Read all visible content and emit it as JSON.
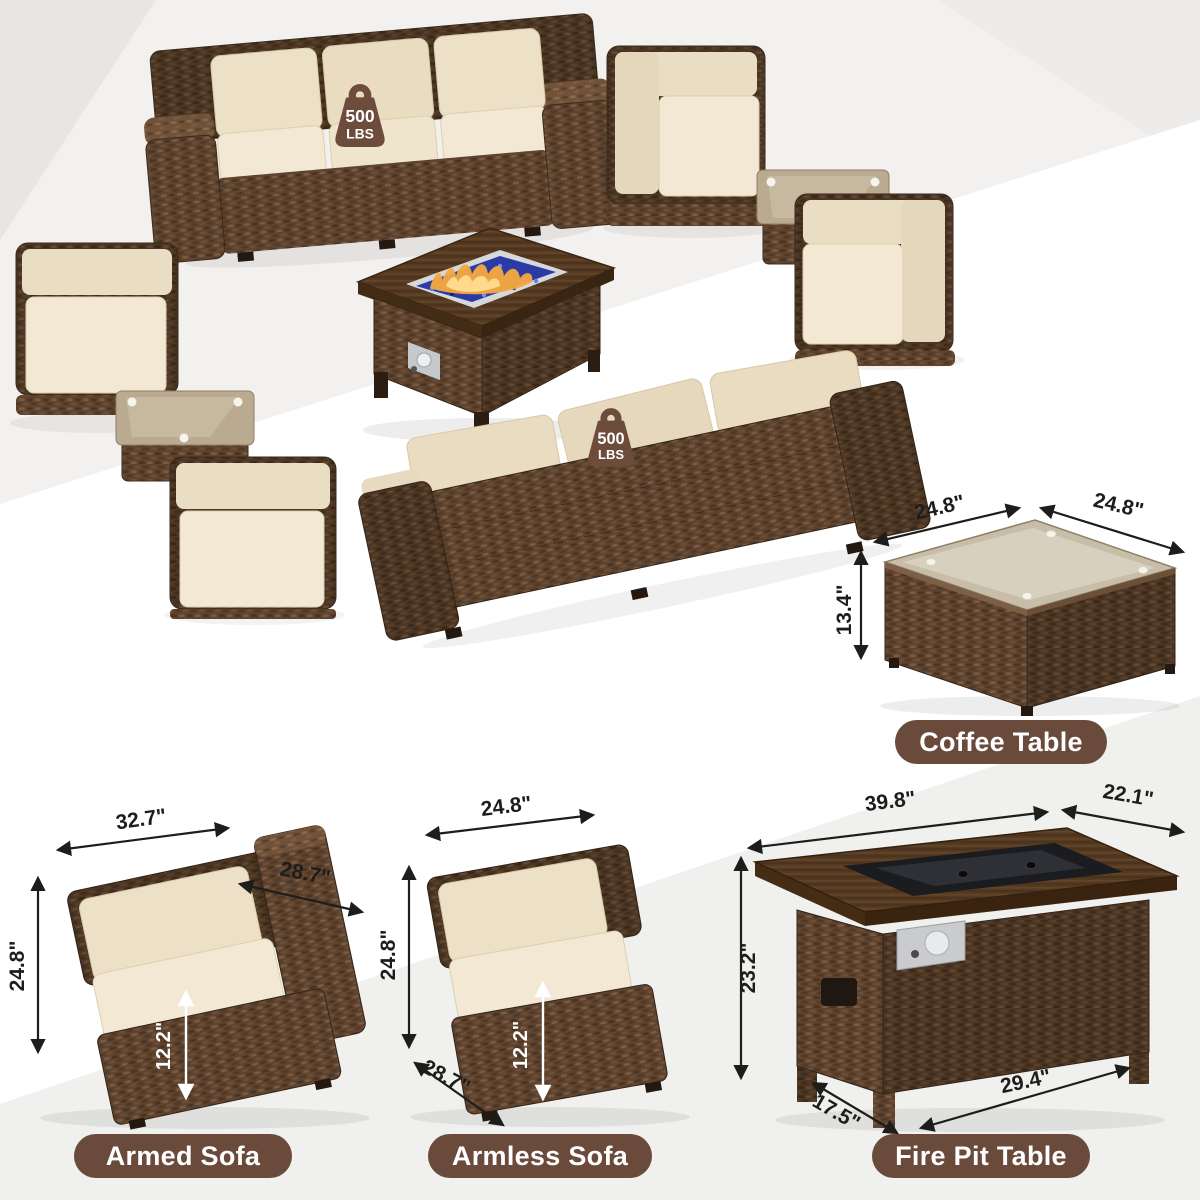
{
  "badge": {
    "value": "500",
    "unit": "LBS"
  },
  "products": {
    "coffee_table": {
      "label": "Coffee Table",
      "dims": {
        "top_width": "24.8\"",
        "top_depth": "24.8\"",
        "height": "13.4\""
      }
    },
    "armed_sofa": {
      "label": "Armed Sofa",
      "dims": {
        "width": "32.7\"",
        "depth": "28.7\"",
        "height": "24.8\"",
        "seat_height": "12.2\""
      }
    },
    "armless_sofa": {
      "label": "Armless Sofa",
      "dims": {
        "width": "24.8\"",
        "height": "24.8\"",
        "seat_height": "12.2\"",
        "depth": "28.7\""
      }
    },
    "fire_pit_table": {
      "label": "Fire Pit Table",
      "dims": {
        "top_width": "39.8\"",
        "top_depth": "22.1\"",
        "height": "23.2\"",
        "base_depth": "17.5\"",
        "base_width": "29.4\""
      }
    }
  },
  "colors": {
    "pill_bg": "#6a4a3b",
    "badge_bg": "#6d4c3b",
    "dimension_text": "#1d1d1b",
    "wicker_brown": "#5d4330",
    "cushion_beige": "#ece0c7",
    "fire_glass_blue": "#2b3aa4",
    "flame_orange": "#f6a93f"
  }
}
